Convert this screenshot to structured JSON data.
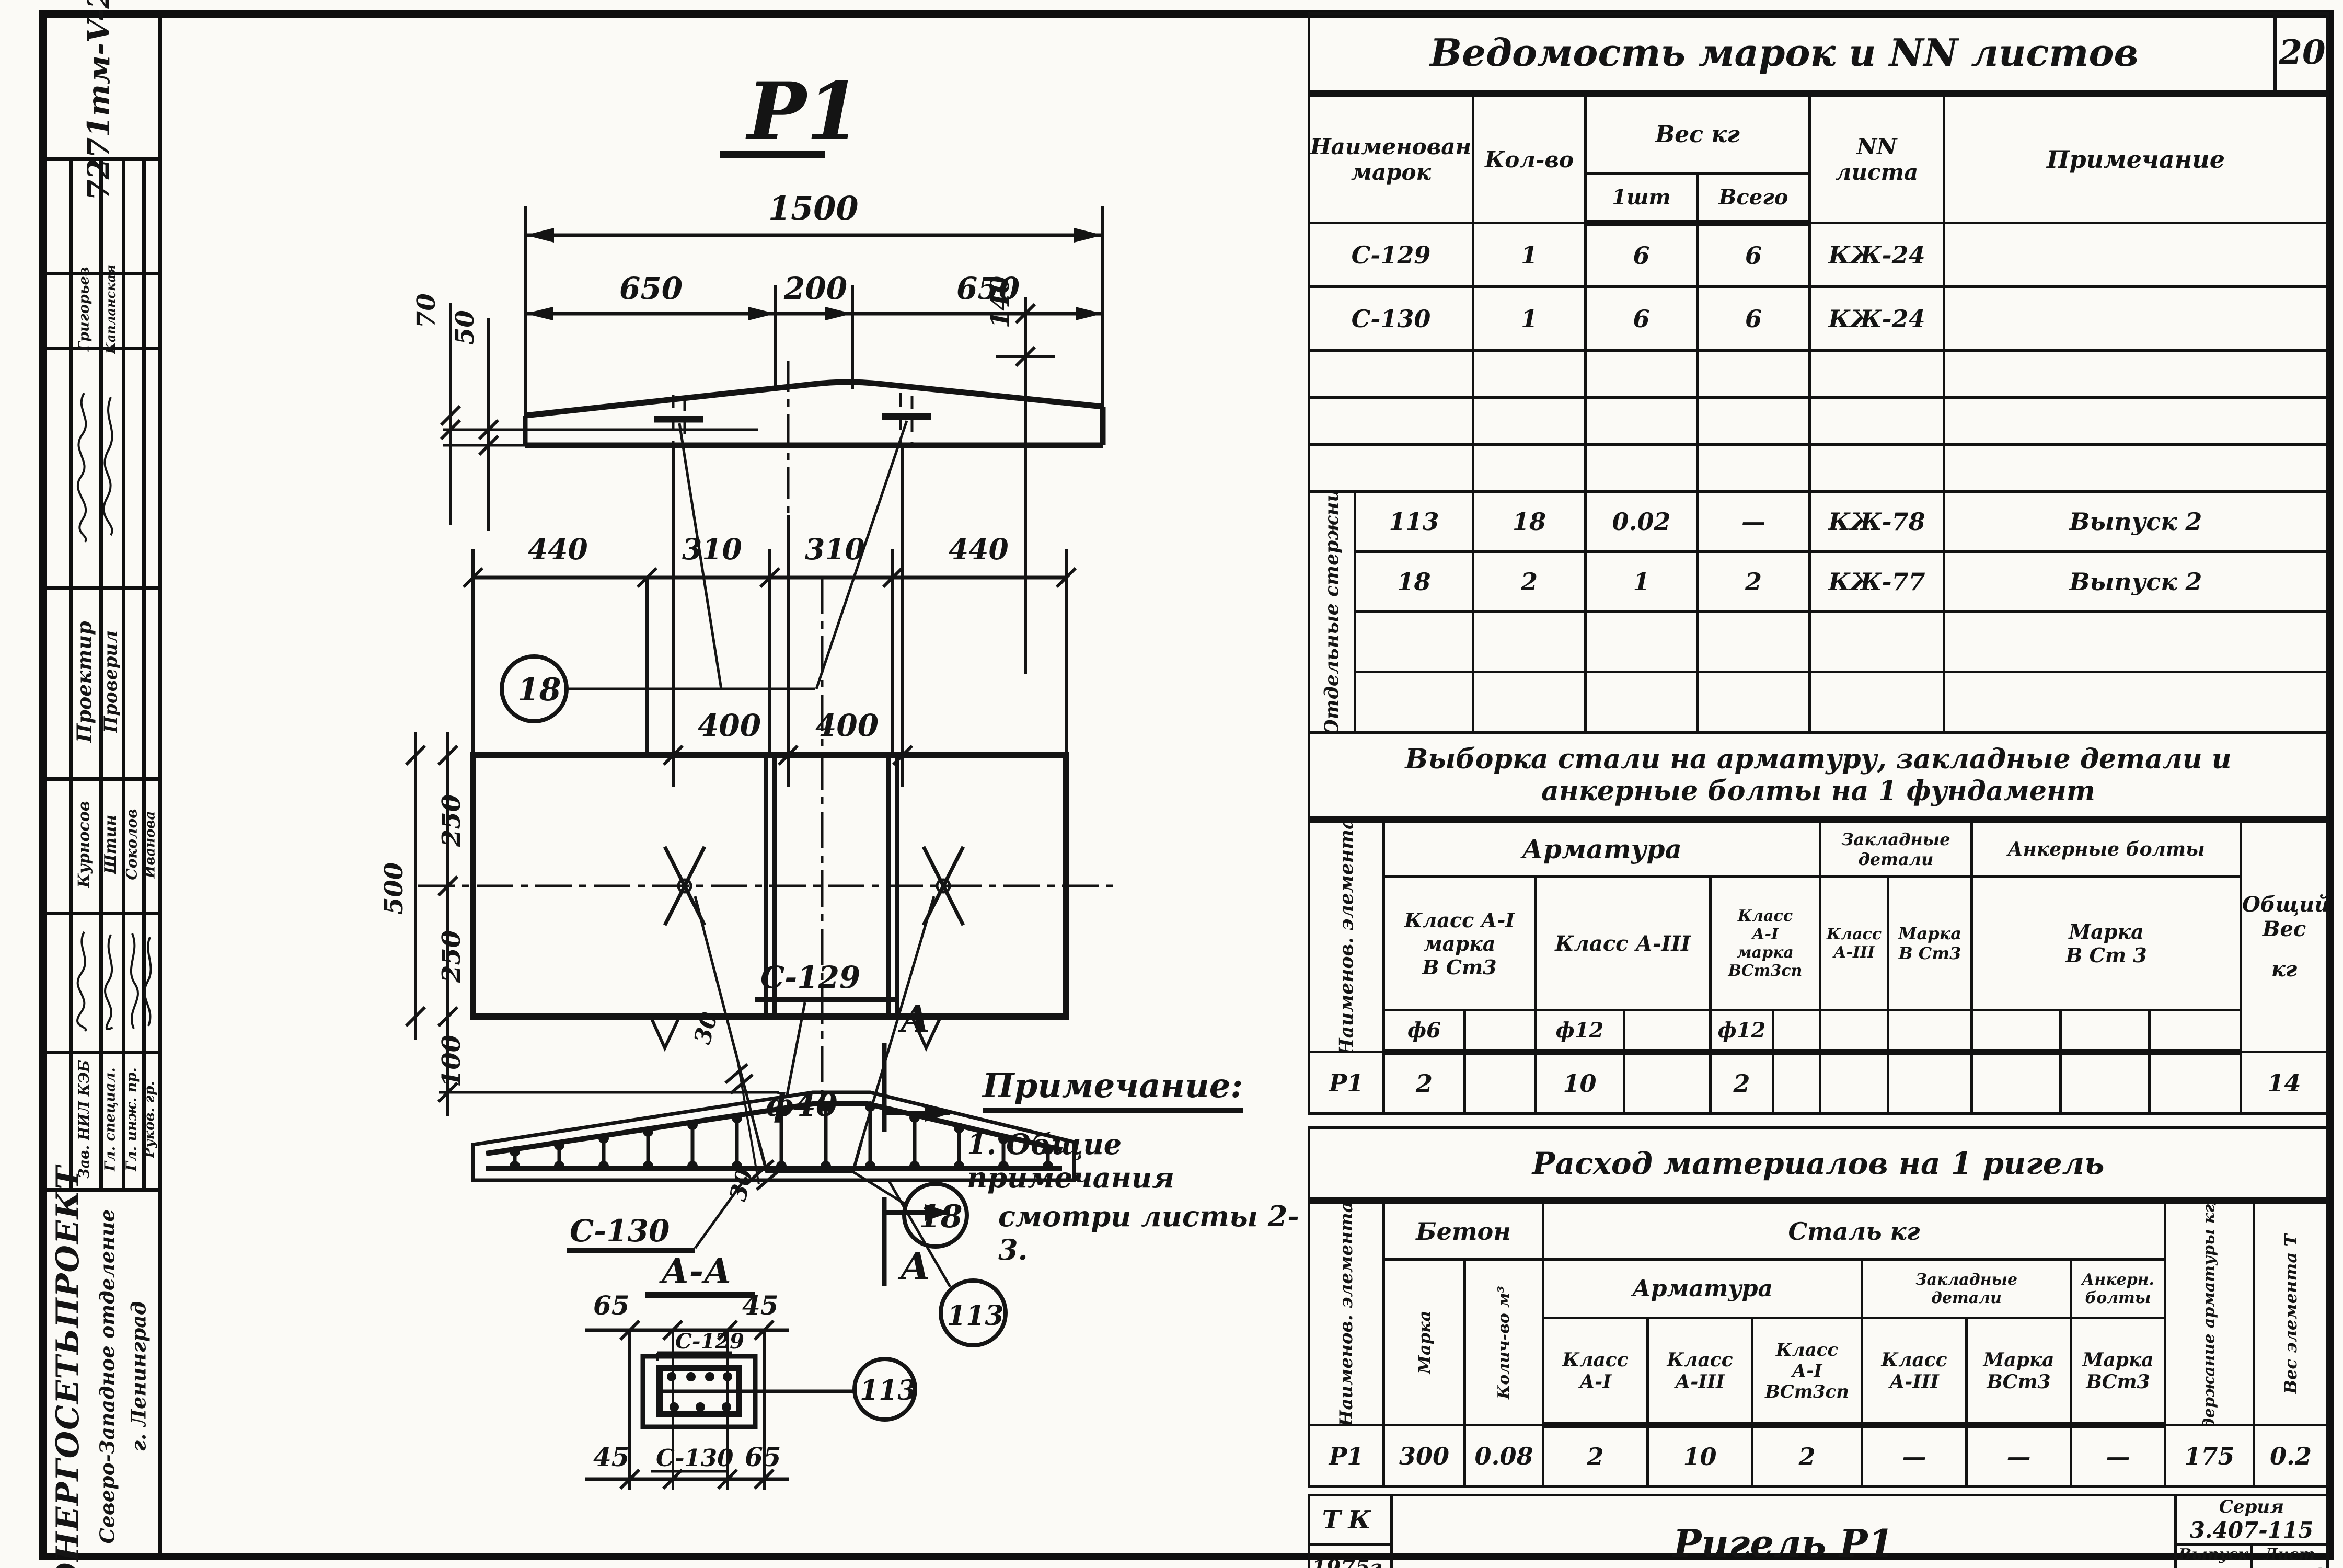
{
  "stamp": {
    "doc_number": "7271тм-V-20"
  },
  "page_number": "20",
  "sidebar": {
    "names1": [
      "Григорьев",
      "Капланская"
    ],
    "roles1": [
      "Проектир",
      "Проверил"
    ],
    "names2": [
      "Курносов",
      "Штин",
      "Соколов",
      "Иванова"
    ],
    "roles2": [
      "Зав. НИЛ КЭБ",
      "Гл. специал.",
      "Гл. инж. пр.",
      "Руков. гр."
    ],
    "org": [
      "ЭНЕРГОСЕТЬПРОЕКТ",
      "Северо-Западное отделение",
      "г. Ленинград"
    ]
  },
  "drawings": {
    "elevation": {
      "title": "Р1",
      "dim_total": "1500",
      "dims_top": [
        "650",
        "200",
        "650"
      ],
      "dim_left_upper": "70",
      "dim_left_lower": "50",
      "dim_right": "140",
      "dims_bottom": [
        "400",
        "400"
      ],
      "callout": "18"
    },
    "plan": {
      "dims_top": [
        "440",
        "310",
        "310",
        "440"
      ],
      "dim_250a": "250",
      "dim_250b": "250",
      "dim_500": "500",
      "dim_100": "100",
      "bolt_label": "ф40",
      "callout": "18"
    },
    "rebar": {
      "label_top": "С-129",
      "label_bottom": "С-130",
      "dim_offset_top": "30",
      "dim_offset_bottom": "30",
      "section_letter": "А",
      "callout": "113"
    },
    "section": {
      "title": "А-А",
      "dim_top_left": "65",
      "dim_top_right": "45",
      "dim_bottom_left": "45",
      "dim_bottom_right": "65",
      "label_top": "С-129",
      "label_bottom": "С-130",
      "callout": "113"
    }
  },
  "note": {
    "title": "Примечание:",
    "lines": [
      "1. Общие примечания",
      "смотри листы 2-3."
    ]
  },
  "table_marks": {
    "title": "Ведомость марок и NN листов",
    "headers": {
      "name": [
        "Наименование",
        "марок"
      ],
      "qty": "Кол-во",
      "weight": "Вес кг",
      "w1": "1шт",
      "wtotal": "Всего",
      "sheet": [
        "NN",
        "листа"
      ],
      "note": "Примечание"
    },
    "rows": [
      [
        "С-129",
        "1",
        "6",
        "6",
        "КЖ-24",
        ""
      ],
      [
        "С-130",
        "1",
        "6",
        "6",
        "КЖ-24",
        ""
      ],
      [
        "",
        "",
        "",
        "",
        "",
        ""
      ],
      [
        "",
        "",
        "",
        "",
        "",
        ""
      ],
      [
        "",
        "",
        "",
        "",
        "",
        ""
      ]
    ],
    "section_label": "Отдельные стержни",
    "section_rows": [
      [
        "113",
        "18",
        "0.02",
        "—",
        "КЖ-78",
        "Выпуск 2"
      ],
      [
        "18",
        "2",
        "1",
        "2",
        "КЖ-77",
        "Выпуск 2"
      ],
      [
        "",
        "",
        "",
        "",
        "",
        ""
      ],
      [
        "",
        "",
        "",
        "",
        "",
        ""
      ]
    ]
  },
  "table_steel": {
    "title": [
      "Выборка стали на арматуру, закладные детали и",
      "анкерные болты на 1 фундамент"
    ],
    "col_element": "Наименов. элемента",
    "groups": {
      "armature": "Арматура",
      "embed": [
        "Закладные",
        "детали"
      ],
      "anchor": "Анкерные болты"
    },
    "col_total": [
      "Общий",
      "Вес",
      "кг"
    ],
    "classes": {
      "c1": [
        "Класс А-I",
        "марка",
        "В Ст3"
      ],
      "c2": "Класс А-III",
      "c3": [
        "Класс",
        "А-I",
        "марка",
        "ВСт3сп"
      ],
      "c4": [
        "Класс",
        "А-III"
      ],
      "c5": [
        "Марка",
        "В Ст3"
      ],
      "c6": [
        "Марка",
        "В Ст 3"
      ]
    },
    "phi": {
      "p1": "ф6",
      "p2": "ф12",
      "p3": "ф12"
    },
    "row": {
      "element": "Р1",
      "v1": "2",
      "v2": "10",
      "v3": "2",
      "total": "14"
    }
  },
  "table_materials": {
    "title": "Расход материалов на 1 ригель",
    "col_element": "Наименов. элемента",
    "concrete": {
      "label": "Бетон",
      "mark": "Марка",
      "qty": "Колич-во м³"
    },
    "steel": {
      "label": "Сталь кг",
      "armature": "Арматура",
      "embed": [
        "Закладные",
        "детали"
      ],
      "anchor": [
        "Анкерн.",
        "болты"
      ]
    },
    "classes": {
      "c1": [
        "Класс",
        "А-I"
      ],
      "c2": [
        "Класс",
        "А-III"
      ],
      "c3": [
        "Класс",
        "А-I",
        "ВСт3сп"
      ],
      "c4": [
        "Класс",
        "А-III"
      ],
      "c5": [
        "Марка",
        "ВСт3"
      ],
      "c6": [
        "Марка",
        "ВСт3"
      ]
    },
    "col_content": "Содержание арматуры кг/м³",
    "col_weight": "Вес элемента Т",
    "row": [
      "Р1",
      "300",
      "0.08",
      "2",
      "10",
      "2",
      "—",
      "—",
      "—",
      "175",
      "0.2"
    ]
  },
  "title_block": {
    "org_code": "ТК",
    "year": "1975г.",
    "title": "Ригель Р1",
    "series_label": "Серия",
    "series": "3.407-115",
    "issue_label": "Выпуск",
    "issue": "5",
    "sheet_label": "Лист",
    "sheet": "КЖ-12"
  }
}
